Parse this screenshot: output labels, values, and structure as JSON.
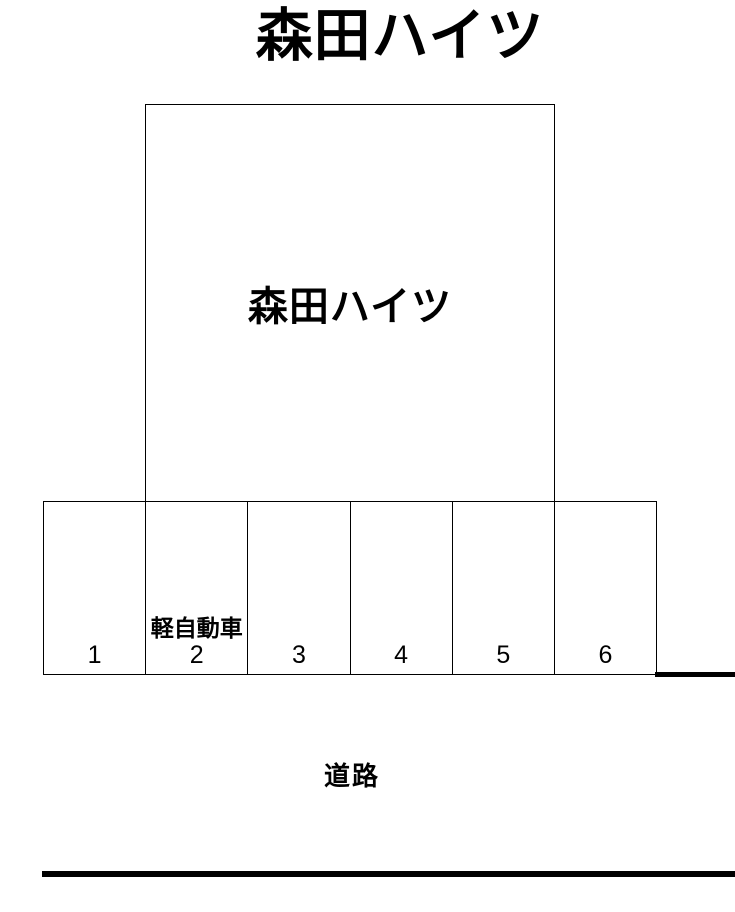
{
  "page": {
    "background_color": "#ffffff",
    "line_color": "#000000"
  },
  "title": "森田ハイツ",
  "building": {
    "label": "森田ハイツ"
  },
  "parking": {
    "spaces": [
      {
        "number": "1",
        "note": ""
      },
      {
        "number": "2",
        "note": "軽自動車"
      },
      {
        "number": "3",
        "note": ""
      },
      {
        "number": "4",
        "note": ""
      },
      {
        "number": "5",
        "note": ""
      },
      {
        "number": "6",
        "note": ""
      }
    ]
  },
  "road": {
    "label": "道路"
  }
}
